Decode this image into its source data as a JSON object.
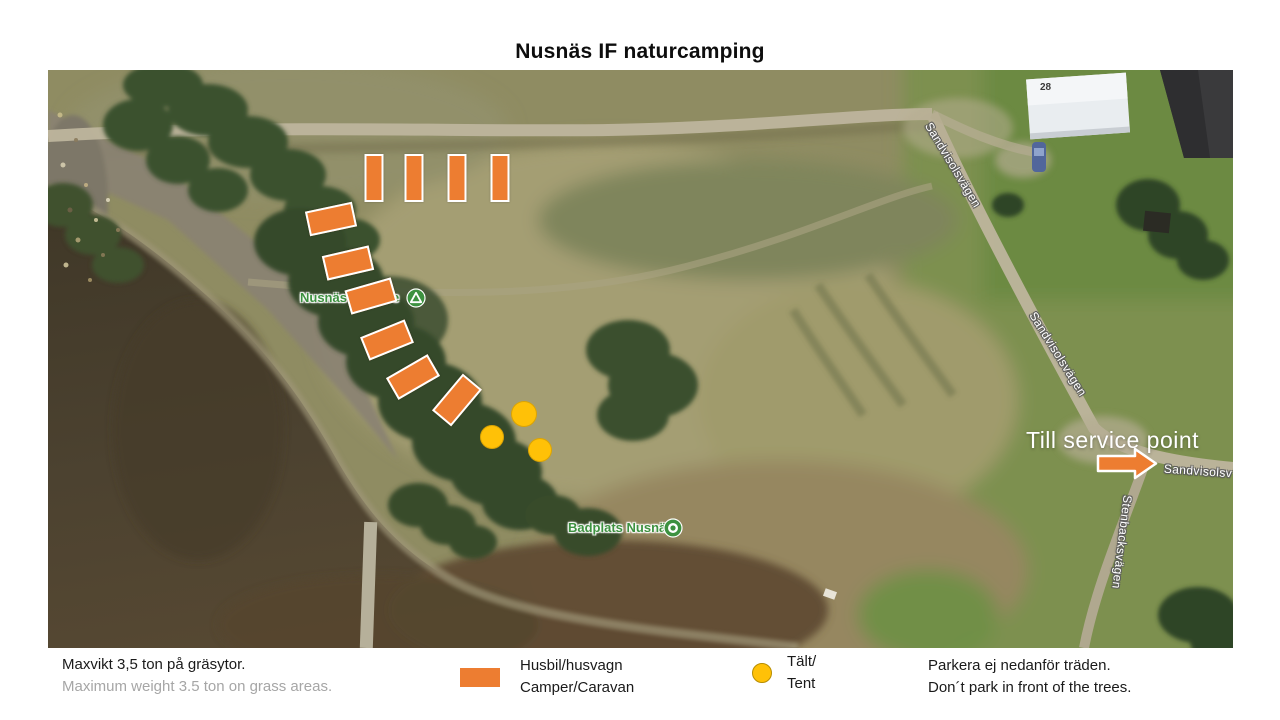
{
  "title": "Nusnäs IF naturcamping",
  "map": {
    "service_label": "Till service point",
    "house_number": "28",
    "poi_camping": {
      "name": "Nusnäs",
      "visible_suffix": "e",
      "icon": "campground-icon"
    },
    "poi_badplats": {
      "name": "Badplats Nusnäs",
      "icon": "swimming-icon"
    },
    "road_labels": [
      {
        "text": "Sandvisolsvägen",
        "x": 905,
        "y": 95,
        "rot": 59
      },
      {
        "text": "Sandvisolsvägen",
        "x": 1010,
        "y": 284,
        "rot": 58
      },
      {
        "text": "Stenbacksvägen",
        "x": 1074,
        "y": 472,
        "rot": 97
      },
      {
        "text": "Sandvisolsv",
        "x": 1150,
        "y": 401,
        "rot": 4
      }
    ],
    "camper_spots": [
      {
        "x": 326,
        "y": 108,
        "w": 15,
        "h": 44,
        "rot": 0
      },
      {
        "x": 366,
        "y": 108,
        "w": 15,
        "h": 44,
        "rot": 0
      },
      {
        "x": 409,
        "y": 108,
        "w": 15,
        "h": 44,
        "rot": 0
      },
      {
        "x": 452,
        "y": 108,
        "w": 15,
        "h": 44,
        "rot": 0
      },
      {
        "x": 283,
        "y": 149,
        "w": 44,
        "h": 21,
        "rot": -12
      },
      {
        "x": 300,
        "y": 193,
        "w": 44,
        "h": 21,
        "rot": -13
      },
      {
        "x": 323,
        "y": 226,
        "w": 44,
        "h": 21,
        "rot": -16
      },
      {
        "x": 339,
        "y": 270,
        "w": 44,
        "h": 21,
        "rot": -22
      },
      {
        "x": 365,
        "y": 307,
        "w": 44,
        "h": 21,
        "rot": -30
      },
      {
        "x": 409,
        "y": 330,
        "w": 44,
        "h": 21,
        "rot": -50
      }
    ],
    "tent_spots": [
      {
        "x": 476,
        "y": 344,
        "r": 13
      },
      {
        "x": 444,
        "y": 367,
        "r": 12
      },
      {
        "x": 492,
        "y": 380,
        "r": 12
      }
    ],
    "colors": {
      "camper": "#ED7D31",
      "tent": "#FFC107",
      "poi_green": "#3d9140"
    }
  },
  "legend": {
    "max_weight_sv": "Maxvikt 3,5 ton på gräsytor.",
    "max_weight_en": "Maximum  weight 3.5 ton on grass areas.",
    "camper_sv": "Husbil/husvagn",
    "camper_en": "Camper/Caravan",
    "tent_sv": "Tält/",
    "tent_en": "Tent",
    "no_park_sv": "Parkera ej nedanför träden.",
    "no_park_en": "Don´t park in front of the trees."
  }
}
